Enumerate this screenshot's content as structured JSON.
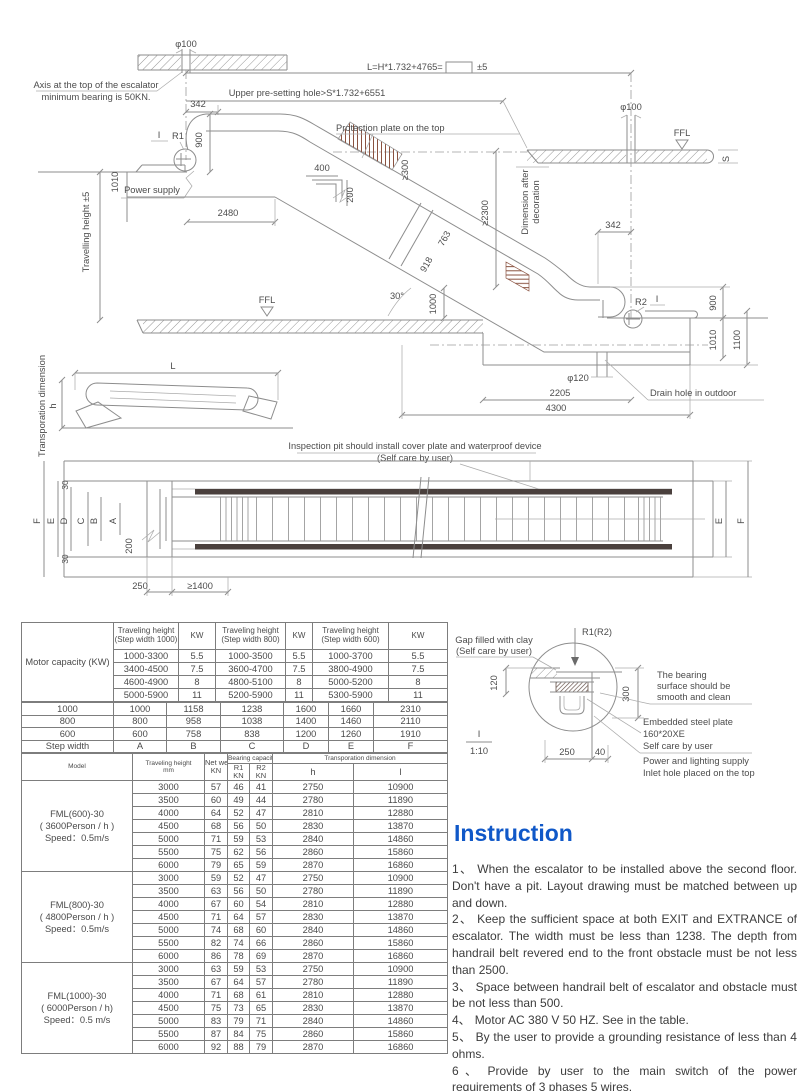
{
  "colors": {
    "accent_blue": "#1058c8",
    "hatch_brown": "#8a5240",
    "bar_dark": "#4a403d",
    "line_gray": "#8d8d8d"
  },
  "drawing": {
    "phi100": "φ100",
    "formula": "L=H*1.732+4765=",
    "pm5": "±5",
    "upper_hole": "Upper pre-setting hole>S*1.732+6551",
    "axis1": "Axis at the top of the escalator",
    "axis2": "minimum bearing is 50KN.",
    "d342": "342",
    "sec": "I",
    "r1": "R1",
    "r2": "R2",
    "d900": "900",
    "d1010": "1010",
    "d1100": "1100",
    "power": "Power supply",
    "trav": "Travelling height ±5",
    "d2480": "2480",
    "prot": "Protection plate on the top",
    "d400": "400",
    "d200": "200",
    "ge300": "≥300",
    "d763": "763",
    "d918": "918",
    "deg30": "30°",
    "d1000": "1000",
    "ge2300": "≥2300",
    "deco1": "Dimension after",
    "deco2": "decoration",
    "ffl": "FFL",
    "s": "S",
    "phi120": "φ120",
    "d2205": "2205",
    "d4300": "4300",
    "drain": "Drain hole in outdoor",
    "L": "L",
    "h": "h",
    "transp": "Transporation dimension",
    "pit1": "Inspection pit should install cover plate and waterproof device",
    "pit2": "(Self care by user)",
    "d250": "250",
    "ge1400": "≥1400",
    "d30": "30",
    "plan": {
      "A": "A",
      "B": "B",
      "C": "C",
      "D": "D",
      "E": "E",
      "F": "F"
    }
  },
  "detail": {
    "gap1": "Gap filled with clay",
    "gap2": "(Self care by user)",
    "r1r2": "R1(R2)",
    "d120": "120",
    "d300": "300",
    "b1": "The bearing",
    "b2": "surface should be",
    "b3": "smooth and clean",
    "e1": "Embedded steel plate",
    "e2": "160*20XE",
    "e3": "Self care by user",
    "pw1": "Power and lighting supply",
    "pw2": "Inlet hole placed on the top",
    "sec": "I",
    "scale": "1:10",
    "d250": "250",
    "d40": "40"
  },
  "tables": {
    "t1": {
      "left_header": "Motor capacity (KW)",
      "col_headers": [
        "Traveling height (Step width 1000)",
        "KW",
        "Traveling height (Step width 800)",
        "KW",
        "Traveling height (Step width 600)",
        "KW"
      ],
      "motor_rows": [
        [
          "1000-3300",
          "5.5",
          "1000-3500",
          "5.5",
          "1000-3700",
          "5.5"
        ],
        [
          "3400-4500",
          "7.5",
          "3600-4700",
          "7.5",
          "3800-4900",
          "7.5"
        ],
        [
          "4600-4900",
          "8",
          "4800-5100",
          "8",
          "5000-5200",
          "8"
        ],
        [
          "5000-5900",
          "11",
          "5200-5900",
          "11",
          "5300-5900",
          "11"
        ]
      ],
      "width_rows": [
        [
          "1000",
          "1000",
          "1158",
          "1238",
          "1600",
          "1660",
          "2310"
        ],
        [
          "800",
          "800",
          "958",
          "1038",
          "1400",
          "1460",
          "2110"
        ],
        [
          "600",
          "600",
          "758",
          "838",
          "1200",
          "1260",
          "1910"
        ],
        [
          "Step width",
          "A",
          "B",
          "C",
          "D",
          "E",
          "F"
        ]
      ]
    },
    "t2": {
      "headers": {
        "model": "Model",
        "traveling": "Traveling height",
        "mm": "mm",
        "net": "Net weight",
        "kn": "KN",
        "bearing": "Bearing capacity",
        "r1": "R1",
        "r2": "R2",
        "transport": "Transporation dimension",
        "h": "h",
        "l": "l"
      },
      "groups": [
        {
          "model_lines": [
            "FML(600)-30",
            "( 3600Person / h )",
            "Speed：0.5m/s"
          ],
          "rows": [
            [
              "3000",
              "57",
              "46",
              "41",
              "2750",
              "10900"
            ],
            [
              "3500",
              "60",
              "49",
              "44",
              "2780",
              "11890"
            ],
            [
              "4000",
              "64",
              "52",
              "47",
              "2810",
              "12880"
            ],
            [
              "4500",
              "68",
              "56",
              "50",
              "2830",
              "13870"
            ],
            [
              "5000",
              "71",
              "59",
              "53",
              "2840",
              "14860"
            ],
            [
              "5500",
              "75",
              "62",
              "56",
              "2860",
              "15860"
            ],
            [
              "6000",
              "79",
              "65",
              "59",
              "2870",
              "16860"
            ]
          ]
        },
        {
          "model_lines": [
            "FML(800)-30",
            "( 4800Person / h )",
            "Speed：0.5m/s"
          ],
          "rows": [
            [
              "3000",
              "59",
              "52",
              "47",
              "2750",
              "10900"
            ],
            [
              "3500",
              "63",
              "56",
              "50",
              "2780",
              "11890"
            ],
            [
              "4000",
              "67",
              "60",
              "54",
              "2810",
              "12880"
            ],
            [
              "4500",
              "71",
              "64",
              "57",
              "2830",
              "13870"
            ],
            [
              "5000",
              "74",
              "68",
              "60",
              "2840",
              "14860"
            ],
            [
              "5500",
              "82",
              "74",
              "66",
              "2860",
              "15860"
            ],
            [
              "6000",
              "86",
              "78",
              "69",
              "2870",
              "16860"
            ]
          ]
        },
        {
          "model_lines": [
            "FML(1000)-30",
            "( 6000Person / h)",
            "Speed：0.5 m/s"
          ],
          "rows": [
            [
              "3000",
              "63",
              "59",
              "53",
              "2750",
              "10900"
            ],
            [
              "3500",
              "67",
              "64",
              "57",
              "2780",
              "11890"
            ],
            [
              "4000",
              "71",
              "68",
              "61",
              "2810",
              "12880"
            ],
            [
              "4500",
              "75",
              "73",
              "65",
              "2830",
              "13870"
            ],
            [
              "5000",
              "83",
              "79",
              "71",
              "2840",
              "14860"
            ],
            [
              "5500",
              "87",
              "84",
              "75",
              "2860",
              "15860"
            ],
            [
              "6000",
              "92",
              "88",
              "79",
              "2870",
              "16860"
            ]
          ]
        }
      ]
    }
  },
  "instruction": {
    "title": "Instruction",
    "items": [
      {
        "num": "1、",
        "text": "When the escalator to be installed above the second floor.  Don't have a pit. Layout drawing must be matched between up and down."
      },
      {
        "num": "2、",
        "text": "Keep the sufficient space at both EXIT and EXTRANCE of escalator.  The width must be less than 1238.  The depth from handrail belt revered end to the front obstacle must be not less than 2500."
      },
      {
        "num": "3、",
        "text": "Space between handrail belt of escalator and obstacle must be not less than 500."
      },
      {
        "num": "4、",
        "text": "Motor AC 380 V 50 HZ. See in the table."
      },
      {
        "num": "5、",
        "text": "By the user to provide a grounding resistance of less than 4 ohms."
      },
      {
        "num": "6、",
        "text": "Provide by user to the main switch of the power requirements of 3 phases 5 wires."
      },
      {
        "num": "7、",
        "text": "All the dimensions are measured by MM."
      }
    ]
  }
}
